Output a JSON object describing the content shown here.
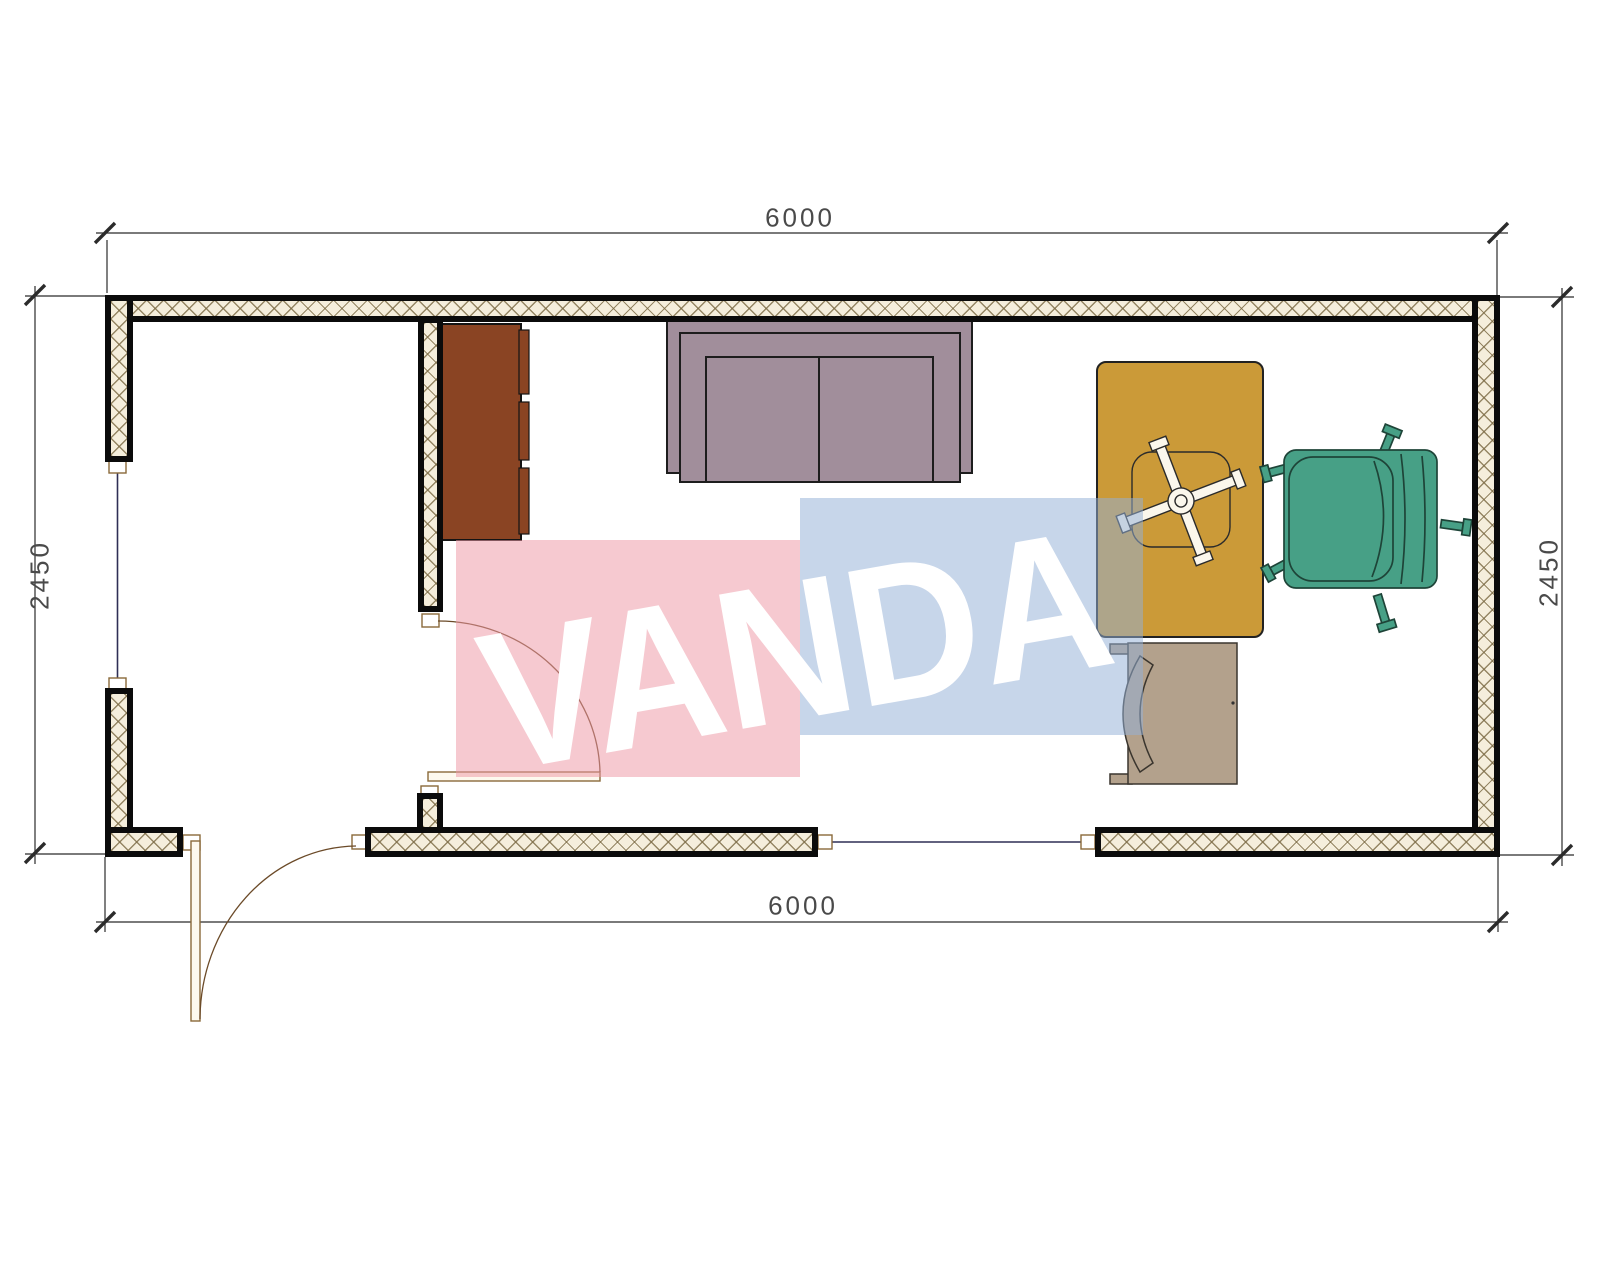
{
  "page": {
    "title": "Container floor plan drawing"
  },
  "dimensions": {
    "top": "6000",
    "bottom": "6000",
    "left": "2450",
    "right": "2450"
  },
  "watermark": {
    "text": "VANDA",
    "pink_color": "#ee98a5",
    "blue_color": "#94b1d6",
    "text_color": "#ffffff"
  },
  "colors": {
    "wall_fill": "#f5eedc",
    "hatch_line": "#7d6c46",
    "cabinet": "#8a4423",
    "sofa": "#a18e9b",
    "desk": "#cb9a38",
    "chair_green": "#47a086",
    "chair_tan": "#b3a18c",
    "chair_symbol": "#fbf7ec",
    "door_leaf": "#fdf9ee",
    "window_frame_fill": "#ffffff",
    "dim_line": "#2b2b2b"
  },
  "furniture": [
    {
      "name": "cabinet"
    },
    {
      "name": "sofa"
    },
    {
      "name": "desk"
    },
    {
      "name": "office-chair-symbol"
    },
    {
      "name": "armchair-green"
    },
    {
      "name": "visitor-chair"
    }
  ]
}
